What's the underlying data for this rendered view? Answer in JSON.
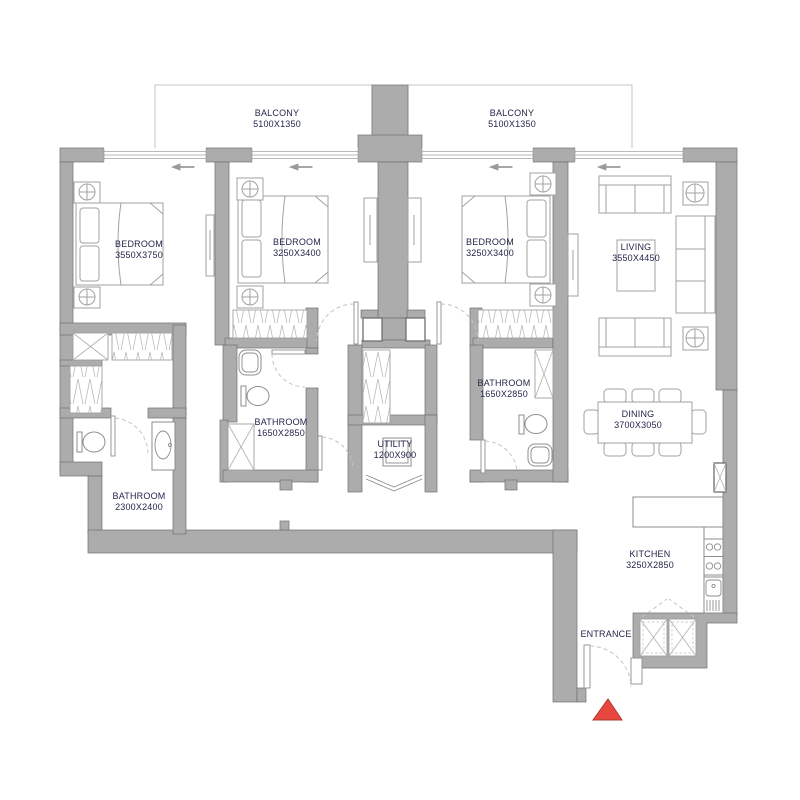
{
  "plan": {
    "title_hint": "3-bedroom apartment floor plan",
    "rooms": {
      "balcony1": {
        "name": "BALCONY",
        "dims": "5100X1350"
      },
      "balcony2": {
        "name": "BALCONY",
        "dims": "5100X1350"
      },
      "bedroom1": {
        "name": "BEDROOM",
        "dims": "3550X3750"
      },
      "bedroom2": {
        "name": "BEDROOM",
        "dims": "3250X3400"
      },
      "bedroom3": {
        "name": "BEDROOM",
        "dims": "3250X3400"
      },
      "living": {
        "name": "LIVING",
        "dims": "3550X4450"
      },
      "dining": {
        "name": "DINING",
        "dims": "3700X3050"
      },
      "kitchen": {
        "name": "KITCHEN",
        "dims": "3250X2850"
      },
      "bathroom1": {
        "name": "BATHROOM",
        "dims": "1650X2850"
      },
      "bathroom2": {
        "name": "BATHROOM",
        "dims": "1650X2850"
      },
      "bathroom3": {
        "name": "BATHROOM",
        "dims": "2300X2400"
      },
      "utility": {
        "name": "UTILITY",
        "dims": "1200X900"
      },
      "entrance": {
        "name": "ENTRANCE"
      }
    },
    "colors": {
      "wall": "#acacac",
      "wall_outline": "#717171",
      "label": "#23264a",
      "entrance_marker": "#e8473f",
      "entrance_marker_border": "#b03a2e"
    }
  }
}
